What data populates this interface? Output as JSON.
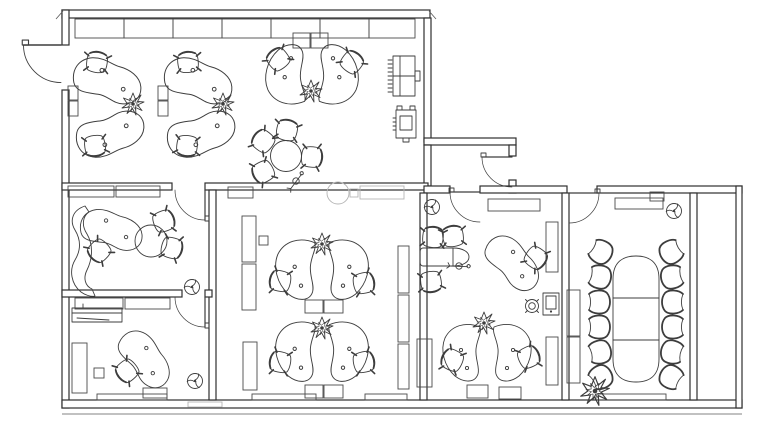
{
  "canvas": {
    "width": 768,
    "height": 424,
    "background": "#ffffff",
    "stroke": "#3d3d3d",
    "wall_stroke": "#2f2f2f",
    "light_stroke": "#b5b5b5"
  },
  "plan": {
    "walls": [
      [
        62,
        10,
        368,
        8
      ],
      [
        62,
        10,
        7,
        35
      ],
      [
        62,
        90,
        7,
        318
      ],
      [
        62,
        400,
        680,
        8
      ],
      [
        424,
        18,
        7,
        124
      ],
      [
        424,
        138,
        92,
        7
      ],
      [
        509,
        145,
        7,
        11
      ],
      [
        509,
        180,
        7,
        13
      ],
      [
        424,
        145,
        7,
        41
      ],
      [
        62,
        183,
        110,
        7
      ],
      [
        205,
        183,
        223,
        7
      ],
      [
        424,
        186,
        26,
        7
      ],
      [
        480,
        186,
        87,
        7
      ],
      [
        597,
        186,
        145,
        7
      ],
      [
        209,
        190,
        7,
        210
      ],
      [
        62,
        290,
        120,
        7
      ],
      [
        205,
        290,
        7,
        7
      ],
      [
        420,
        193,
        7,
        207
      ],
      [
        562,
        193,
        7,
        207
      ],
      [
        690,
        193,
        7,
        207
      ],
      [
        736,
        186,
        6,
        222
      ]
    ],
    "lines": [
      [
        56,
        19,
        63,
        11
      ],
      [
        429,
        11,
        436,
        19
      ],
      [
        62,
        414,
        742,
        414
      ]
    ],
    "cabinets": [
      [
        75,
        19,
        49,
        19
      ],
      [
        124,
        19,
        49,
        19
      ],
      [
        173,
        19,
        49,
        19
      ],
      [
        222,
        19,
        49,
        19
      ],
      [
        271,
        19,
        49,
        19
      ],
      [
        320,
        19,
        49,
        19
      ],
      [
        369,
        19,
        46,
        19
      ],
      [
        293,
        33,
        17,
        15
      ],
      [
        311,
        33,
        17,
        15
      ],
      [
        68,
        86,
        10,
        14
      ],
      [
        68,
        101,
        10,
        15
      ],
      [
        158,
        86,
        10,
        14
      ],
      [
        158,
        101,
        10,
        15
      ],
      [
        228,
        187,
        25,
        11
      ],
      [
        68,
        186,
        46,
        11
      ],
      [
        116,
        186,
        44,
        11
      ],
      [
        242,
        216,
        14,
        46
      ],
      [
        242,
        264,
        14,
        46
      ],
      [
        243,
        342,
        14,
        48
      ],
      [
        259,
        236,
        9,
        9
      ],
      [
        398,
        246,
        11,
        47
      ],
      [
        398,
        295,
        11,
        47
      ],
      [
        398,
        344,
        11,
        45
      ],
      [
        305,
        300,
        18,
        13
      ],
      [
        324,
        300,
        19,
        13
      ],
      [
        305,
        385,
        18,
        13
      ],
      [
        324,
        385,
        19,
        13
      ],
      [
        75,
        298,
        48,
        11
      ],
      [
        125,
        298,
        45,
        11
      ],
      [
        72,
        343,
        15,
        50
      ],
      [
        94,
        368,
        10,
        10
      ],
      [
        143,
        388,
        24,
        10
      ],
      [
        488,
        199,
        52,
        12
      ],
      [
        417,
        339,
        15,
        48
      ],
      [
        546,
        222,
        12,
        50
      ],
      [
        546,
        337,
        12,
        48
      ],
      [
        467,
        385,
        21,
        13
      ],
      [
        499,
        387,
        22,
        12
      ],
      [
        615,
        198,
        48,
        11
      ],
      [
        567,
        290,
        13,
        46
      ],
      [
        567,
        337,
        13,
        46
      ],
      [
        650,
        192,
        14,
        9
      ],
      [
        97,
        394,
        70,
        6
      ],
      [
        252,
        394,
        64,
        6
      ],
      [
        365,
        394,
        42,
        6
      ],
      [
        596,
        394,
        70,
        6
      ]
    ],
    "light": {
      "circles": [
        [
          338,
          193,
          11
        ]
      ],
      "rects": [
        [
          350,
          189,
          8,
          8
        ],
        [
          360,
          186,
          44,
          13
        ],
        [
          188,
          402,
          34,
          5
        ]
      ]
    },
    "doors": [
      {
        "t": "translate(61,45) scale(-1.25,1.25)"
      },
      {
        "t": "translate(205,190) rotate(90)"
      },
      {
        "t": "translate(205,297) rotate(90)"
      },
      {
        "t": "translate(512,157) scale(-1,1)"
      },
      {
        "t": "translate(480,192) scale(-1,1)"
      },
      {
        "t": "translate(569,193)"
      }
    ],
    "furniture": [
      {
        "type": "kidney-desk",
        "t": "translate(108,82) rotate(14) scale(1.1)"
      },
      {
        "type": "kidney-desk",
        "t": "translate(111,133) scale(1.1,-1.1) rotate(14)"
      },
      {
        "type": "kidney-desk",
        "t": "translate(199,82) rotate(14) scale(1.1)"
      },
      {
        "type": "kidney-desk",
        "t": "translate(202,133) scale(1.1,-1.1) rotate(14)"
      },
      {
        "type": "kidney-desk",
        "t": "translate(112,231) rotate(12)"
      },
      {
        "type": "kidney-desk",
        "t": "translate(513,264) rotate(42)"
      },
      {
        "type": "kidney-desk",
        "t": "translate(145,360) rotate(48)"
      },
      {
        "type": "desk-pair",
        "t": "translate(312,73) scale(1.05,-1.05)"
      },
      {
        "type": "desk-pair",
        "t": "translate(322,271) scale(1.05)"
      },
      {
        "type": "desk-pair",
        "t": "translate(322,353) scale(1.05)"
      },
      {
        "type": "desk-pair",
        "t": "translate(487,354)"
      },
      {
        "type": "round-table",
        "t": "translate(286,156)"
      },
      {
        "type": "oval-table",
        "t": "translate(445,257)"
      },
      {
        "type": "conference-table",
        "t": "translate(636,319)"
      },
      {
        "type": "circle-extension",
        "t": "translate(151,241)"
      },
      {
        "type": "curved-sofa",
        "t": "translate(79,252)"
      },
      {
        "type": "counter",
        "t": "translate(97,315)"
      },
      {
        "type": "copier-large",
        "t": "translate(404,76)"
      },
      {
        "type": "copier-small",
        "t": "translate(406,124)"
      },
      {
        "type": "safe",
        "t": "translate(551,304)"
      },
      {
        "type": "stool",
        "t": "translate(532,306)"
      },
      {
        "type": "coat-stand",
        "t": "translate(296,181) rotate(-15)"
      },
      {
        "type": "coat-stand",
        "t": "translate(459,266) rotate(40)"
      },
      {
        "type": "plant",
        "t": "translate(133,104)"
      },
      {
        "type": "plant",
        "t": "translate(223,104)"
      },
      {
        "type": "plant",
        "t": "translate(311,91)"
      },
      {
        "type": "plant",
        "t": "translate(322,244)"
      },
      {
        "type": "plant",
        "t": "translate(322,328)"
      },
      {
        "type": "plant",
        "t": "translate(484,323)"
      },
      {
        "type": "plant",
        "t": "translate(595,391) scale(1.3)"
      },
      {
        "type": "fan",
        "t": "translate(432,207)"
      },
      {
        "type": "fan",
        "t": "translate(192,287)"
      },
      {
        "type": "fan",
        "t": "translate(195,381)"
      },
      {
        "type": "fan",
        "t": "translate(674,211)"
      },
      {
        "type": "chair",
        "t": "translate(97,62) rotate(8)"
      },
      {
        "type": "chair",
        "t": "translate(95,146) rotate(172)"
      },
      {
        "type": "chair",
        "t": "translate(188,62) rotate(-6)"
      },
      {
        "type": "chair",
        "t": "translate(187,146) rotate(186)"
      },
      {
        "type": "chair",
        "t": "translate(278,59) rotate(-38)"
      },
      {
        "type": "chair",
        "t": "translate(352,62) rotate(38)"
      },
      {
        "type": "chair",
        "t": "translate(287,130) rotate(12)"
      },
      {
        "type": "chair",
        "t": "translate(263,141) rotate(-52)"
      },
      {
        "type": "chair",
        "t": "translate(263,172) rotate(-118)"
      },
      {
        "type": "chair",
        "t": "translate(312,157) rotate(95)"
      },
      {
        "type": "chair",
        "t": "translate(280,281) rotate(-78)"
      },
      {
        "type": "chair",
        "t": "translate(364,283) rotate(78)"
      },
      {
        "type": "chair",
        "t": "translate(280,362) rotate(-78)"
      },
      {
        "type": "chair",
        "t": "translate(364,362) rotate(78)"
      },
      {
        "type": "chair",
        "t": "translate(164,221) rotate(70)"
      },
      {
        "type": "chair",
        "t": "translate(172,248) rotate(105)"
      },
      {
        "type": "chair",
        "t": "translate(99,251) rotate(-135)"
      },
      {
        "type": "chair",
        "t": "translate(127,371) rotate(-130)"
      },
      {
        "type": "chair",
        "t": "translate(536,258) rotate(125)"
      },
      {
        "type": "chair",
        "t": "translate(433,237) rotate(6)"
      },
      {
        "type": "chair",
        "t": "translate(453,236) rotate(-8)"
      },
      {
        "type": "chair",
        "t": "translate(431,282) rotate(172)"
      },
      {
        "type": "chair",
        "t": "translate(452,360) rotate(-65)"
      },
      {
        "type": "chair",
        "t": "translate(529,357) rotate(65)"
      },
      {
        "type": "conf-chair",
        "t": "translate(601,252) rotate(-60)"
      },
      {
        "type": "conf-chair",
        "t": "translate(600,277) rotate(-78)"
      },
      {
        "type": "conf-chair",
        "t": "translate(599,302) rotate(-90)"
      },
      {
        "type": "conf-chair",
        "t": "translate(599,327) rotate(-90)"
      },
      {
        "type": "conf-chair",
        "t": "translate(600,352) rotate(-102)"
      },
      {
        "type": "conf-chair",
        "t": "translate(601,377) rotate(-120)"
      },
      {
        "type": "conf-chair",
        "t": "translate(671,252) rotate(60)"
      },
      {
        "type": "conf-chair",
        "t": "translate(672,277) rotate(78)"
      },
      {
        "type": "conf-chair",
        "t": "translate(673,302) rotate(90)"
      },
      {
        "type": "conf-chair",
        "t": "translate(673,327) rotate(90)"
      },
      {
        "type": "conf-chair",
        "t": "translate(672,352) rotate(102)"
      },
      {
        "type": "conf-chair",
        "t": "translate(671,377) rotate(120)"
      }
    ]
  }
}
